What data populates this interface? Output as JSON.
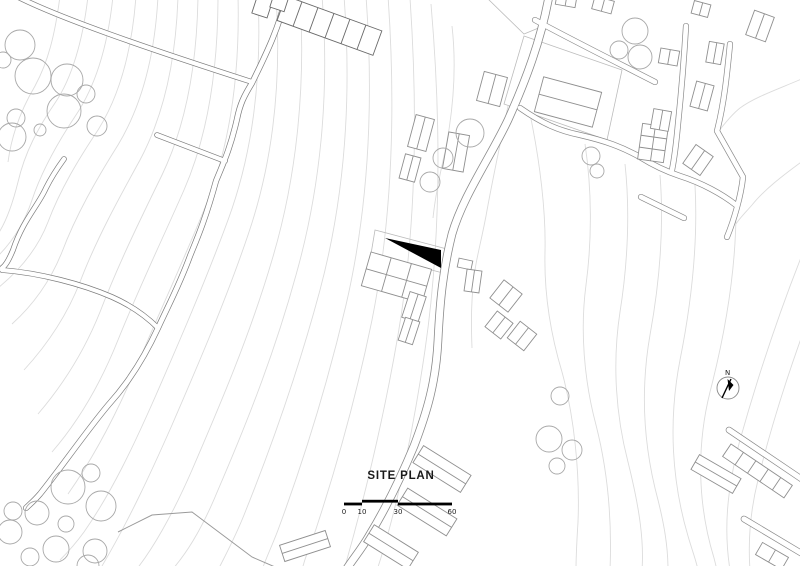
{
  "drawing": {
    "title": "SITE PLAN",
    "north_label": "N",
    "scale_bar": {
      "ticks": [
        "0",
        "10",
        "30",
        "60"
      ]
    },
    "colors": {
      "background": "#ffffff",
      "contour": "#dcdcdc",
      "plot_boundary": "#bcbcbc",
      "road": "#8a8a8a",
      "road_dark": "#7c7c7c",
      "building": "#8f8f8f",
      "building_dark": "#6a6a6a",
      "tree": "#a8a8a8",
      "site_marker": "#000000",
      "text": "#1a1a1a"
    }
  }
}
